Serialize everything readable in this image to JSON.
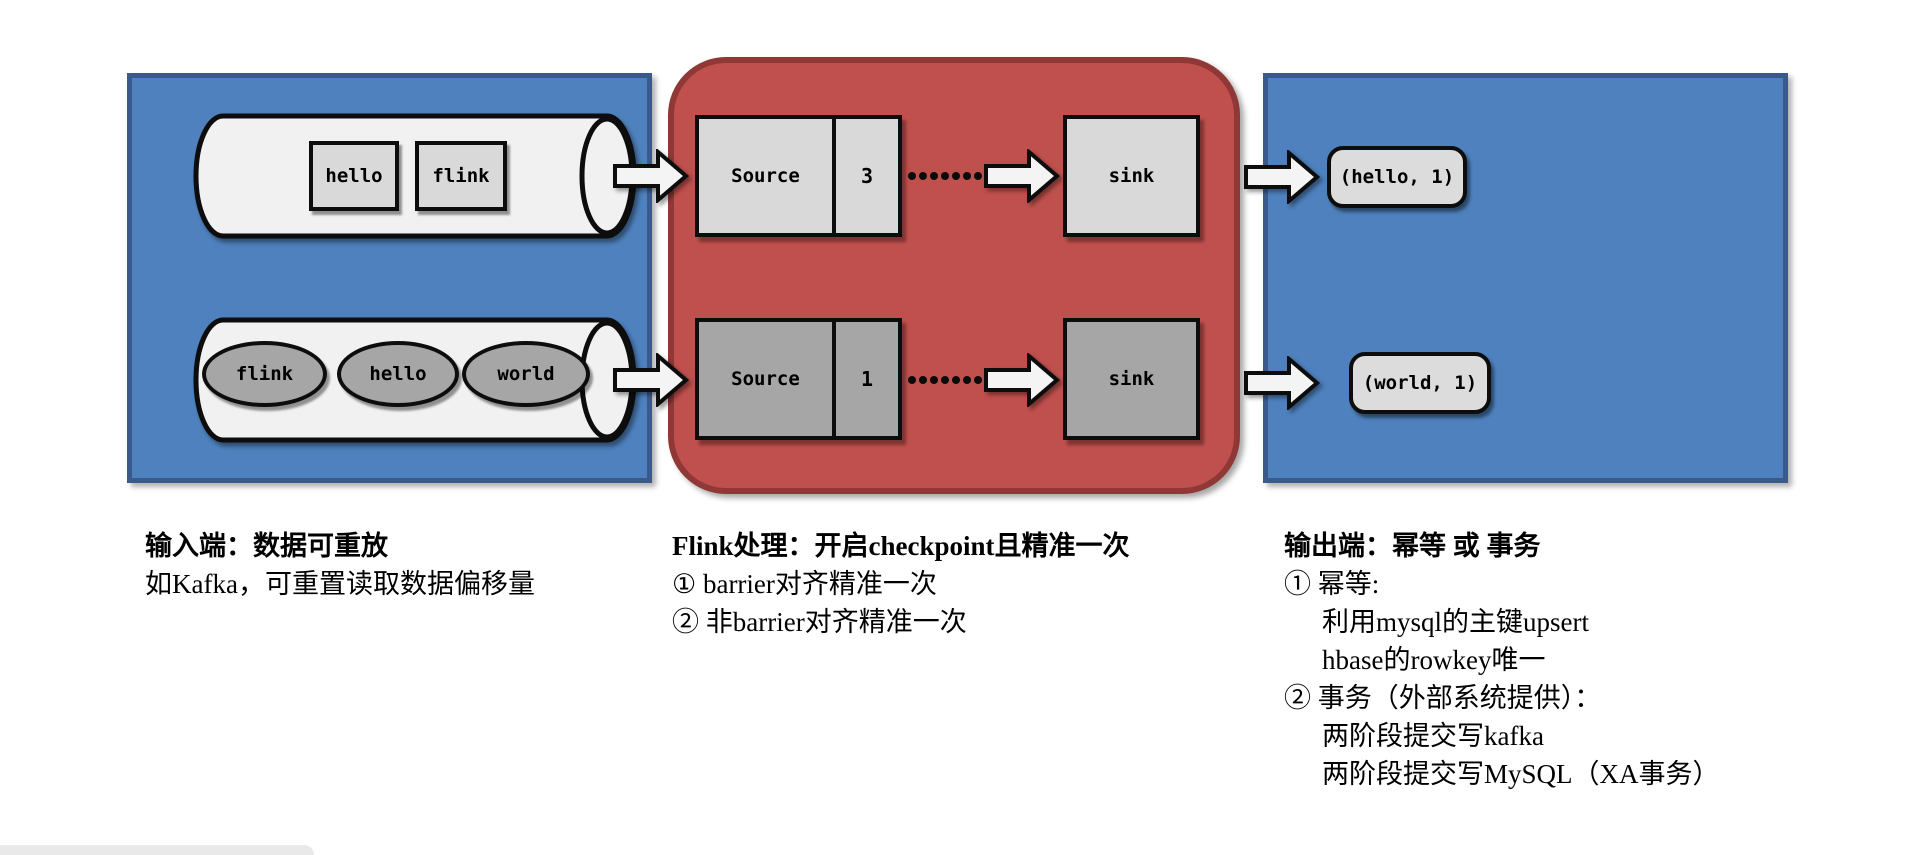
{
  "colors": {
    "input_box_fill": "#4E81BD",
    "input_box_border": "#3A5A8B",
    "process_box_fill": "#C0504D",
    "process_box_border": "#8F3836",
    "light_node_fill": "#D9D9D9",
    "dark_node_fill": "#A6A6A6",
    "cylinder_fill": "#F1F1F1",
    "outline": "#0D0D0D",
    "arrow_fill": "#F4F4F4",
    "result_pill_fill": "#DCDCDC",
    "statusbar_fill": "#E9E9E9"
  },
  "input_section": {
    "queue_top": {
      "items": [
        "hello",
        "flink"
      ]
    },
    "queue_bottom": {
      "items": [
        "flink",
        "hello",
        "world"
      ]
    }
  },
  "processing_section": {
    "rows": [
      {
        "source_label": "Source",
        "buffer_count": "3",
        "sink_label": "sink"
      },
      {
        "source_label": "Source",
        "buffer_count": "1",
        "sink_label": "sink"
      }
    ],
    "dot_count": 7
  },
  "output_section": {
    "results": [
      "(hello, 1)",
      "(world, 1)"
    ]
  },
  "captions": {
    "input": {
      "title": "输入端：数据可重放",
      "lines": [
        "如Kafka，可重置读取数据偏移量"
      ]
    },
    "processing": {
      "title": "Flink处理：开启checkpoint且精准一次",
      "lines": [
        "① barrier对齐精准一次",
        "② 非barrier对齐精准一次"
      ]
    },
    "output": {
      "title": "输出端：幂等 或 事务",
      "lines": [
        "① 幂等:",
        "利用mysql的主键upsert",
        "hbase的rowkey唯一",
        "② 事务（外部系统提供）：",
        "两阶段提交写kafka",
        "两阶段提交写MySQL（XA事务）"
      ]
    }
  }
}
